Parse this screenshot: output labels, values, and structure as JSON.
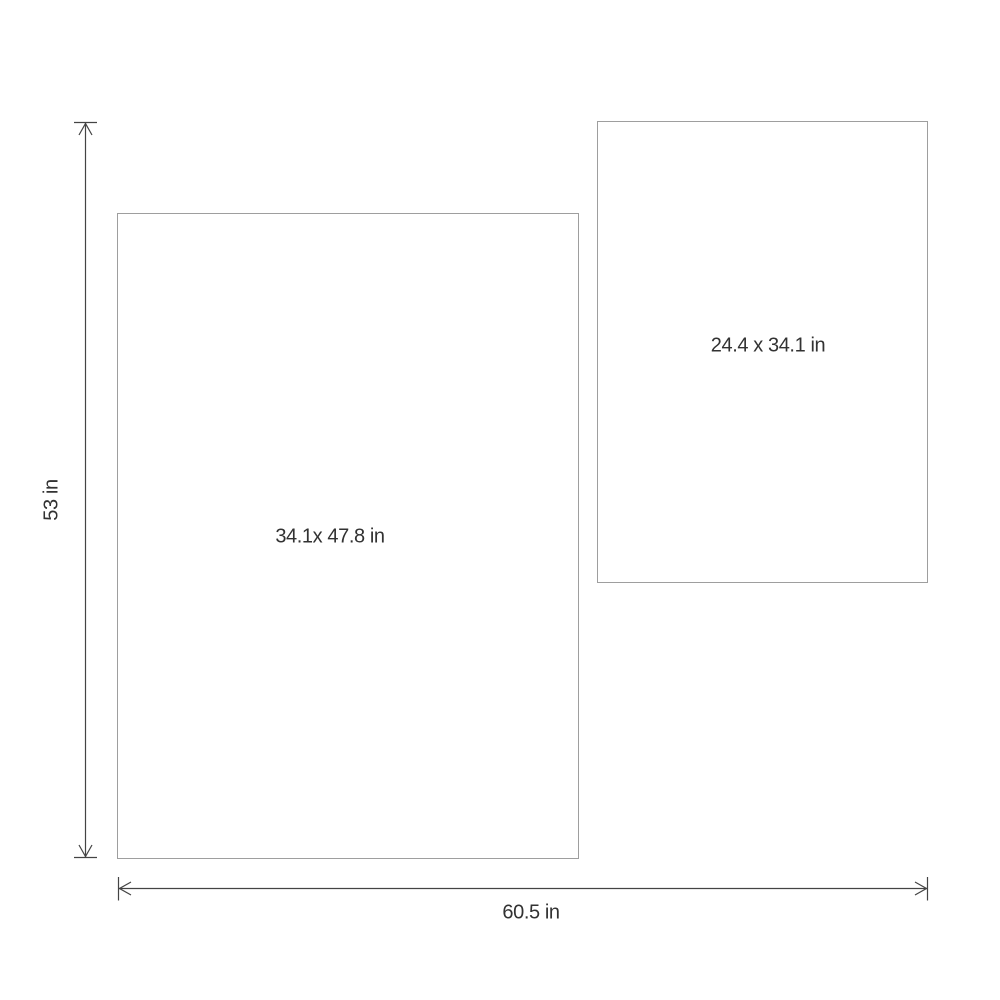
{
  "diagram": {
    "title": "product-dimensions-diagram",
    "panels": [
      {
        "name": "large-panel",
        "label": "34.1x 47.8 in"
      },
      {
        "name": "small-panel",
        "label": "24.4 x 34.1 in"
      }
    ],
    "dimensions": {
      "height_label": "53 in",
      "width_label": "60.5 in"
    },
    "colors": {
      "background": "#ffffff",
      "panel_border": "#9e9e9e",
      "dimension_line": "#444444",
      "label_text": "#323232"
    }
  }
}
